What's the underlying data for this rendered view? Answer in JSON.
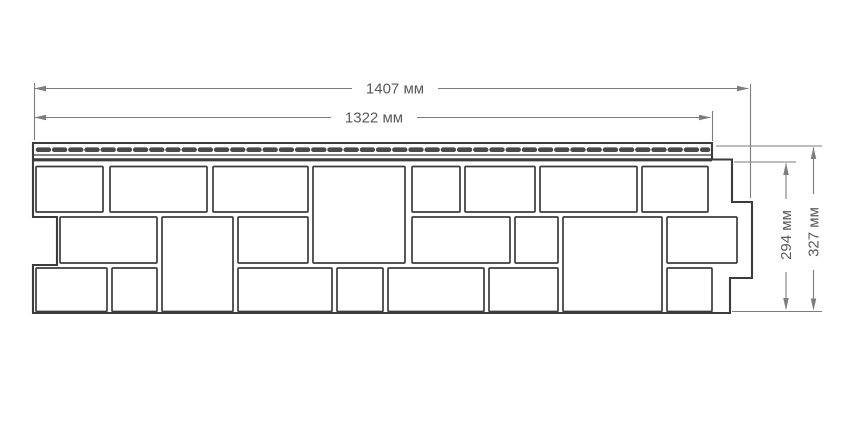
{
  "diagram": {
    "dimension_labels": {
      "outer_width": "1407 мм",
      "nail_strip_width": "1322 мм",
      "panel_height": "294 мм",
      "full_height": "327 мм"
    },
    "colors": {
      "background": "#ffffff",
      "panel_outline": "#3c3c3c",
      "perforation_dash": "#4a4a4a",
      "dimension_line": "#7d7d7d",
      "dimension_text": "#5a5a5a"
    }
  }
}
